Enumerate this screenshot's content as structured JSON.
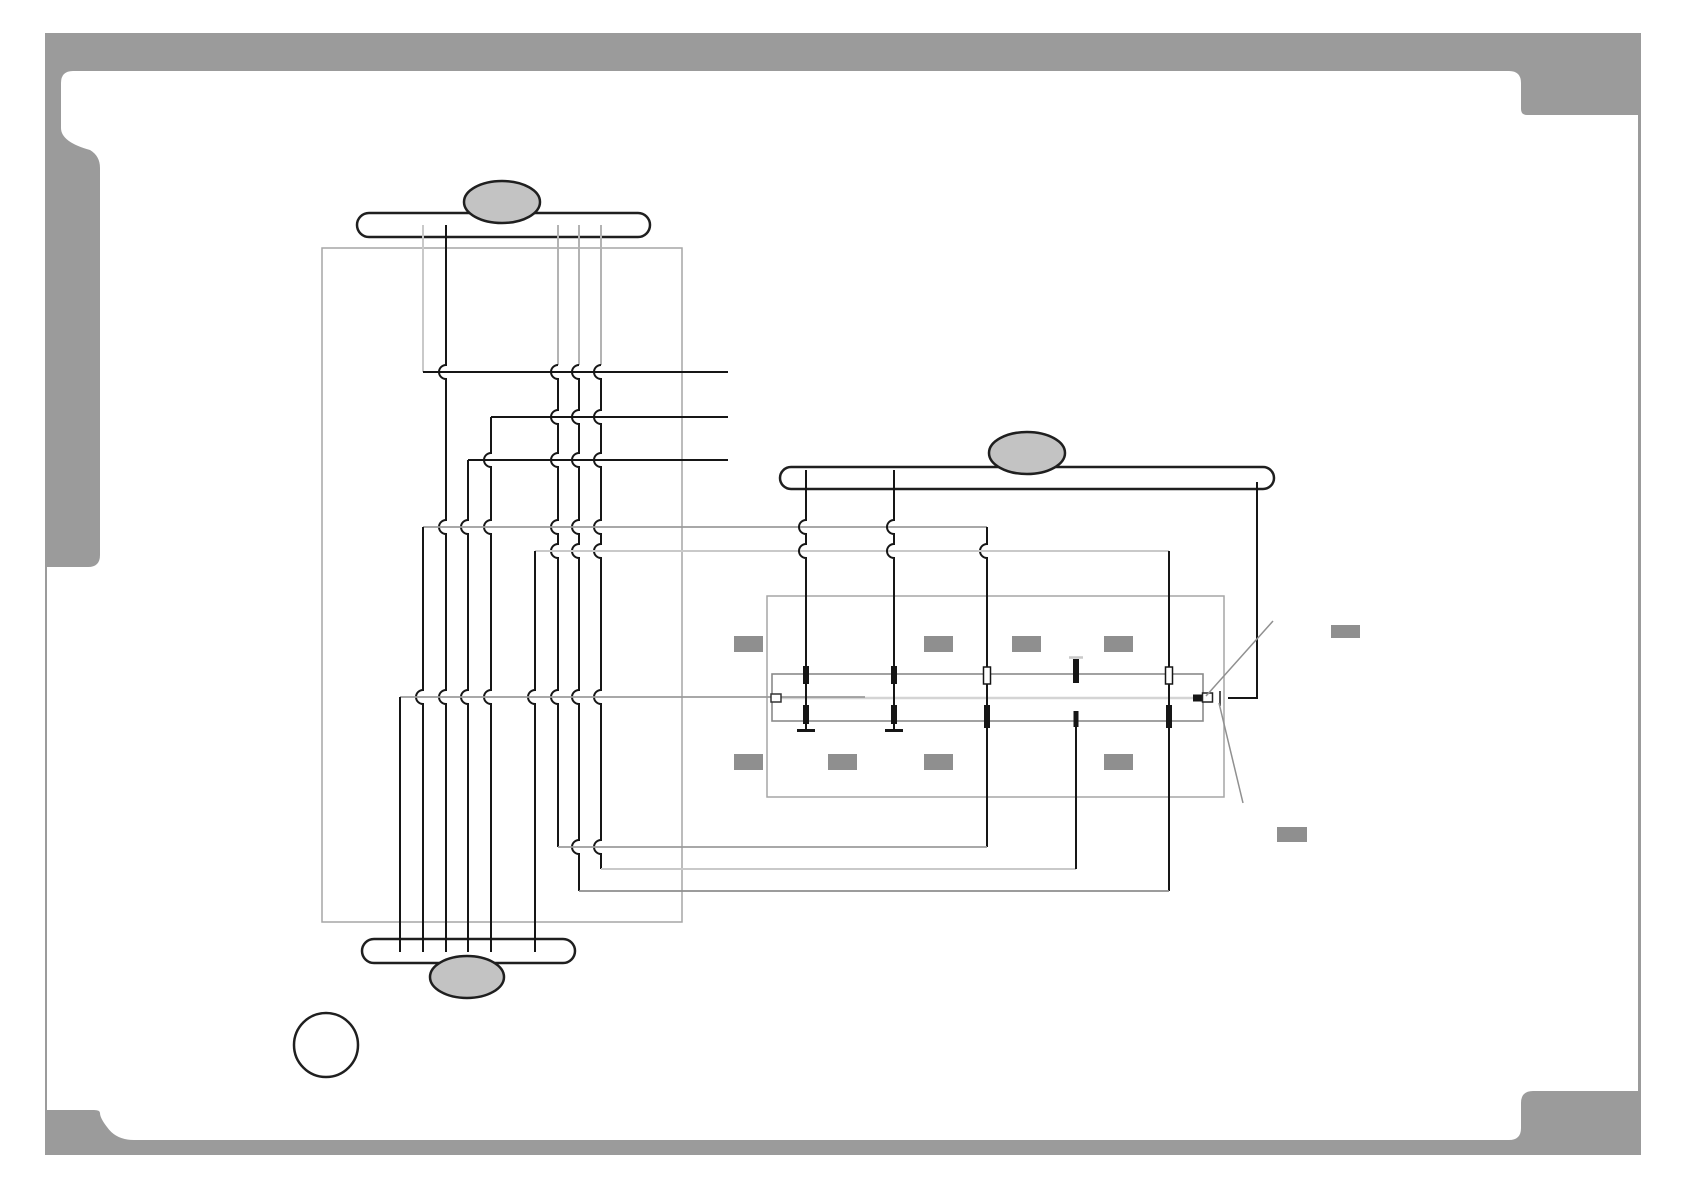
{
  "page": {
    "title": "wiring-connection-diagram",
    "width": 1684,
    "height": 1190,
    "background": "#ffffff"
  },
  "palette": {
    "frame_gray": "#9b9b9b",
    "outline_black": "#1f1f1f",
    "wire_black": "#161616",
    "wire_gray": "#9b9b9b",
    "wire_light_gray": "#c9c9c9",
    "wire_mid_gray": "#8e8e8e",
    "box_outline_gray": "#a6a6a6",
    "strip_outline_gray": "#8a8a8a",
    "oval_fill_gray": "#c3c3c3",
    "tab_fill_gray": "#8f8f8f",
    "strip_midline_gray": "#d4d4d4",
    "leader_gray": "#909090"
  },
  "diagram": {
    "shapes": [
      {
        "name": "page-frame",
        "type": "path",
        "attrs": {
          "d": "M45,33 H1641 V1155 H45 Z M73,71 H1509 Q1521,71 1521,83 V109 Q1521,115 1527,115 H1638 V1091 H1533 Q1521,1091 1521,1103 V1128 Q1521,1140 1509,1140 H134 Q116,1140 107,1127 Q100,1118 100,1113 Q100,1110 94,1110 H47 V567 H88 Q100,567 100,555 V168 Q100,156 90,150 Q61,142 61,128 V83 Q61,71 73,71 Z",
          "fill": "#9b9b9b",
          "fill-rule": "evenodd",
          "stroke": "none"
        }
      },
      {
        "name": "board-outline-left",
        "type": "rect",
        "attrs": {
          "x": 322,
          "y": 248,
          "width": 360,
          "height": 674,
          "fill": "none",
          "stroke": "#a6a6a6",
          "stroke-width": 1.5
        }
      },
      {
        "name": "board-outline-right",
        "type": "rect",
        "attrs": {
          "x": 767,
          "y": 596,
          "width": 457,
          "height": 201,
          "fill": "none",
          "stroke": "#a6a6a6",
          "stroke-width": 1.5
        }
      },
      {
        "name": "connector-strip",
        "type": "rect",
        "attrs": {
          "x": 772,
          "y": 674,
          "width": 431,
          "height": 47,
          "fill": "none",
          "stroke": "#8a8a8a",
          "stroke-width": 1.6
        }
      },
      {
        "name": "connector-strip-midline",
        "type": "path",
        "attrs": {
          "d": "M772,698 H1203",
          "fill": "none",
          "stroke": "#d4d4d4",
          "stroke-width": 2.5
        }
      },
      {
        "name": "bus-bar-top",
        "type": "rect",
        "attrs": {
          "x": 357,
          "y": 213,
          "width": 293,
          "height": 24,
          "rx": 12,
          "fill": "#ffffff",
          "stroke": "#1f1f1f",
          "stroke-width": 2.5
        }
      },
      {
        "name": "bus-bar-middle",
        "type": "rect",
        "attrs": {
          "x": 780,
          "y": 467,
          "width": 494,
          "height": 22,
          "rx": 11,
          "fill": "#ffffff",
          "stroke": "#1f1f1f",
          "stroke-width": 2.5
        }
      },
      {
        "name": "bus-bar-bottom",
        "type": "rect",
        "attrs": {
          "x": 362,
          "y": 939,
          "width": 213,
          "height": 24,
          "rx": 12,
          "fill": "#ffffff",
          "stroke": "#1f1f1f",
          "stroke-width": 2.5
        }
      },
      {
        "name": "cable-oval-top",
        "type": "ellipse",
        "attrs": {
          "cx": 502,
          "cy": 202,
          "rx": 38,
          "ry": 21,
          "fill": "#c3c3c3",
          "stroke": "#1f1f1f",
          "stroke-width": 2.5
        }
      },
      {
        "name": "cable-oval-middle",
        "type": "ellipse",
        "attrs": {
          "cx": 1027,
          "cy": 453,
          "rx": 38,
          "ry": 21,
          "fill": "#c3c3c3",
          "stroke": "#1f1f1f",
          "stroke-width": 2.5
        }
      },
      {
        "name": "cable-oval-bottom",
        "type": "ellipse",
        "attrs": {
          "cx": 467,
          "cy": 977,
          "rx": 37,
          "ry": 21,
          "fill": "#c3c3c3",
          "stroke": "#1f1f1f",
          "stroke-width": 2.5
        }
      },
      {
        "name": "callout-circle",
        "type": "circle",
        "attrs": {
          "cx": 326,
          "cy": 1045,
          "r": 32,
          "fill": "#ffffff",
          "stroke": "#1f1f1f",
          "stroke-width": 2.5
        }
      },
      {
        "name": "wire-v1-upper",
        "type": "path",
        "attrs": {
          "d": "M423,225 V372",
          "fill": "none",
          "stroke": "#c9c9c9",
          "stroke-width": 2
        }
      },
      {
        "name": "wire-row-372",
        "type": "path",
        "attrs": {
          "d": "M423,372 H728",
          "fill": "none",
          "stroke": "#161616",
          "stroke-width": 2
        }
      },
      {
        "name": "wire-v2",
        "type": "path",
        "attrs": {
          "d": "M446,225 V365 A7,7 0 0 0 446,379 V520 A7,7 0 0 0 446,534 V690 A7,7 0 0 0 446,704 V952",
          "fill": "none",
          "stroke": "#161616",
          "stroke-width": 2
        }
      },
      {
        "name": "wire-v6-upper",
        "type": "path",
        "attrs": {
          "d": "M558,225 V365",
          "fill": "none",
          "stroke": "#b3b3b3",
          "stroke-width": 2
        }
      },
      {
        "name": "wire-v6",
        "type": "path",
        "attrs": {
          "d": "M558,365 A7,7 0 0 0 558,379 V410 A7,7 0 0 0 558,424 V453 A7,7 0 0 0 558,467 V520 A7,7 0 0 0 558,534 V544 A7,7 0 0 0 558,558 V690 A7,7 0 0 0 558,704 V847",
          "fill": "none",
          "stroke": "#161616",
          "stroke-width": 2
        }
      },
      {
        "name": "wire-v7-upper",
        "type": "path",
        "attrs": {
          "d": "M579,225 V365",
          "fill": "none",
          "stroke": "#b3b3b3",
          "stroke-width": 2
        }
      },
      {
        "name": "wire-v7",
        "type": "path",
        "attrs": {
          "d": "M579,365 A7,7 0 0 0 579,379 V410 A7,7 0 0 0 579,424 V453 A7,7 0 0 0 579,467 V520 A7,7 0 0 0 579,534 V544 A7,7 0 0 0 579,558 V690 A7,7 0 0 0 579,704 V840 A7,7 0 0 0 579,854 V891",
          "fill": "none",
          "stroke": "#161616",
          "stroke-width": 2
        }
      },
      {
        "name": "wire-v8-upper",
        "type": "path",
        "attrs": {
          "d": "M601,225 V365",
          "fill": "none",
          "stroke": "#b3b3b3",
          "stroke-width": 2
        }
      },
      {
        "name": "wire-v8",
        "type": "path",
        "attrs": {
          "d": "M601,365 A7,7 0 0 0 601,379 V410 A7,7 0 0 0 601,424 V453 A7,7 0 0 0 601,467 V520 A7,7 0 0 0 601,534 V544 A7,7 0 0 0 601,558 V690 A7,7 0 0 0 601,704 V840 A7,7 0 0 0 601,854 V869",
          "fill": "none",
          "stroke": "#161616",
          "stroke-width": 2
        }
      },
      {
        "name": "wire-row-417",
        "type": "path",
        "attrs": {
          "d": "M491,417 H728",
          "fill": "none",
          "stroke": "#161616",
          "stroke-width": 2
        }
      },
      {
        "name": "wire-v4",
        "type": "path",
        "attrs": {
          "d": "M491,417 V453 A7,7 0 0 0 491,467 V520 A7,7 0 0 0 491,534 V690 A7,7 0 0 0 491,704 V952",
          "fill": "none",
          "stroke": "#161616",
          "stroke-width": 2
        }
      },
      {
        "name": "wire-row-460",
        "type": "path",
        "attrs": {
          "d": "M468,460 H728",
          "fill": "none",
          "stroke": "#161616",
          "stroke-width": 2
        }
      },
      {
        "name": "wire-v3",
        "type": "path",
        "attrs": {
          "d": "M468,460 V520 A7,7 0 0 0 468,534 V690 A7,7 0 0 0 468,704 V952",
          "fill": "none",
          "stroke": "#161616",
          "stroke-width": 2
        }
      },
      {
        "name": "wire-row-527",
        "type": "path",
        "attrs": {
          "d": "M423,527 H987",
          "fill": "none",
          "stroke": "#9b9b9b",
          "stroke-width": 1.8
        }
      },
      {
        "name": "wire-v1-lower",
        "type": "path",
        "attrs": {
          "d": "M423,527 V690 A7,7 0 0 0 423,704 V952",
          "fill": "none",
          "stroke": "#161616",
          "stroke-width": 2
        }
      },
      {
        "name": "wire-v987",
        "type": "path",
        "attrs": {
          "d": "M987,527 V544 A7,7 0 0 0 987,558 V847",
          "fill": "none",
          "stroke": "#161616",
          "stroke-width": 2
        }
      },
      {
        "name": "wire-row-551",
        "type": "path",
        "attrs": {
          "d": "M535,551 H1169",
          "fill": "none",
          "stroke": "#c9c9c9",
          "stroke-width": 2
        }
      },
      {
        "name": "wire-v5",
        "type": "path",
        "attrs": {
          "d": "M535,551 V690 A7,7 0 0 0 535,704 V952",
          "fill": "none",
          "stroke": "#161616",
          "stroke-width": 2
        }
      },
      {
        "name": "wire-v1169",
        "type": "path",
        "attrs": {
          "d": "M1169,551 V891",
          "fill": "none",
          "stroke": "#161616",
          "stroke-width": 2
        }
      },
      {
        "name": "wire-row-697",
        "type": "path",
        "attrs": {
          "d": "M400,697 H865",
          "fill": "none",
          "stroke": "#9b9b9b",
          "stroke-width": 1.8
        }
      },
      {
        "name": "wire-v400",
        "type": "path",
        "attrs": {
          "d": "M400,697 V952",
          "fill": "none",
          "stroke": "#161616",
          "stroke-width": 2
        }
      },
      {
        "name": "wire-row-847",
        "type": "path",
        "attrs": {
          "d": "M558,847 H987",
          "fill": "none",
          "stroke": "#9b9b9b",
          "stroke-width": 1.8
        }
      },
      {
        "name": "wire-row-869",
        "type": "path",
        "attrs": {
          "d": "M601,869 H1076",
          "fill": "none",
          "stroke": "#c9c9c9",
          "stroke-width": 2
        }
      },
      {
        "name": "wire-row-891",
        "type": "path",
        "attrs": {
          "d": "M579,891 H1169",
          "fill": "none",
          "stroke": "#8e8e8e",
          "stroke-width": 1.8
        }
      },
      {
        "name": "wire-v806",
        "type": "path",
        "attrs": {
          "d": "M806,470 V520 A7,7 0 0 0 806,534 V544 A7,7 0 0 0 806,558 V729",
          "fill": "none",
          "stroke": "#161616",
          "stroke-width": 2
        }
      },
      {
        "name": "wire-v806-foot",
        "type": "path",
        "attrs": {
          "d": "M797,730.5 H815",
          "fill": "none",
          "stroke": "#161616",
          "stroke-width": 3
        }
      },
      {
        "name": "wire-v894",
        "type": "path",
        "attrs": {
          "d": "M894,470 V520 A7,7 0 0 0 894,534 V544 A7,7 0 0 0 894,558 V729",
          "fill": "none",
          "stroke": "#161616",
          "stroke-width": 2
        }
      },
      {
        "name": "wire-v894-foot",
        "type": "path",
        "attrs": {
          "d": "M885,730.5 H903",
          "fill": "none",
          "stroke": "#161616",
          "stroke-width": 3
        }
      },
      {
        "name": "wire-v1257",
        "type": "path",
        "attrs": {
          "d": "M1257,482 V698 H1228",
          "fill": "none",
          "stroke": "#161616",
          "stroke-width": 2
        }
      },
      {
        "name": "strip-end-tick",
        "type": "path",
        "attrs": {
          "d": "M1220,691 V706",
          "fill": "none",
          "stroke": "#161616",
          "stroke-width": 1.5
        }
      },
      {
        "name": "wire-v1076-cap",
        "type": "path",
        "attrs": {
          "d": "M1069,657.5 H1083",
          "fill": "none",
          "stroke": "#c9c9c9",
          "stroke-width": 2.5
        }
      },
      {
        "name": "wire-v1076-pin",
        "type": "rect",
        "attrs": {
          "x": 1073,
          "y": 659,
          "width": 6,
          "height": 24,
          "fill": "#161616",
          "stroke": "none"
        }
      },
      {
        "name": "wire-v1076-lower",
        "type": "path",
        "attrs": {
          "d": "M1076,711 V869",
          "fill": "none",
          "stroke": "#161616",
          "stroke-width": 2
        }
      },
      {
        "name": "wire-v1076-thick",
        "type": "rect",
        "attrs": {
          "x": 1073.5,
          "y": 711,
          "width": 5,
          "height": 16,
          "fill": "#161616",
          "stroke": "none"
        }
      },
      {
        "name": "strip-pin-806-top",
        "type": "rect",
        "attrs": {
          "x": 803,
          "y": 666,
          "width": 6,
          "height": 18,
          "fill": "#161616",
          "stroke": "none"
        }
      },
      {
        "name": "strip-pin-894-top",
        "type": "rect",
        "attrs": {
          "x": 891,
          "y": 666,
          "width": 6,
          "height": 18,
          "fill": "#161616",
          "stroke": "none"
        }
      },
      {
        "name": "strip-pin-806-bottom",
        "type": "rect",
        "attrs": {
          "x": 803,
          "y": 705,
          "width": 6,
          "height": 19,
          "fill": "#161616",
          "stroke": "none"
        }
      },
      {
        "name": "strip-pin-894-bottom",
        "type": "rect",
        "attrs": {
          "x": 891,
          "y": 705,
          "width": 6,
          "height": 19,
          "fill": "#161616",
          "stroke": "none"
        }
      },
      {
        "name": "strip-pin-987-top-hollow",
        "type": "rect",
        "attrs": {
          "x": 983.5,
          "y": 667,
          "width": 7,
          "height": 17,
          "fill": "#ffffff",
          "stroke": "#161616",
          "stroke-width": 1.5
        }
      },
      {
        "name": "strip-pin-987-bottom",
        "type": "rect",
        "attrs": {
          "x": 984,
          "y": 705,
          "width": 6,
          "height": 23,
          "fill": "#161616",
          "stroke": "none"
        }
      },
      {
        "name": "strip-pin-1169-top-hollow",
        "type": "rect",
        "attrs": {
          "x": 1165.5,
          "y": 667,
          "width": 7,
          "height": 17,
          "fill": "#ffffff",
          "stroke": "#161616",
          "stroke-width": 1.5
        }
      },
      {
        "name": "strip-pin-1169-bottom",
        "type": "rect",
        "attrs": {
          "x": 1166,
          "y": 705,
          "width": 6,
          "height": 23,
          "fill": "#161616",
          "stroke": "none"
        }
      },
      {
        "name": "strip-left-connector",
        "type": "rect",
        "attrs": {
          "x": 771,
          "y": 694,
          "width": 10,
          "height": 8,
          "fill": "#ffffff",
          "stroke": "#333333",
          "stroke-width": 1.5
        }
      },
      {
        "name": "strip-right-connector-solid",
        "type": "rect",
        "attrs": {
          "x": 1193,
          "y": 694.5,
          "width": 12,
          "height": 7,
          "fill": "#161616",
          "stroke": "none"
        }
      },
      {
        "name": "strip-right-connector-hollow",
        "type": "rect",
        "attrs": {
          "x": 1202.5,
          "y": 693,
          "width": 10,
          "height": 9,
          "fill": "#ffffff",
          "stroke": "#222222",
          "stroke-width": 1.5
        }
      },
      {
        "name": "label-tab-upper-1",
        "type": "rect",
        "attrs": {
          "x": 734,
          "y": 636,
          "width": 29,
          "height": 16,
          "fill": "#8f8f8f",
          "stroke": "none"
        }
      },
      {
        "name": "label-tab-upper-2",
        "type": "rect",
        "attrs": {
          "x": 924,
          "y": 636,
          "width": 29,
          "height": 16,
          "fill": "#8f8f8f",
          "stroke": "none"
        }
      },
      {
        "name": "label-tab-upper-3",
        "type": "rect",
        "attrs": {
          "x": 1012,
          "y": 636,
          "width": 29,
          "height": 16,
          "fill": "#8f8f8f",
          "stroke": "none"
        }
      },
      {
        "name": "label-tab-upper-4",
        "type": "rect",
        "attrs": {
          "x": 1104,
          "y": 636,
          "width": 29,
          "height": 16,
          "fill": "#8f8f8f",
          "stroke": "none"
        }
      },
      {
        "name": "label-tab-lower-1",
        "type": "rect",
        "attrs": {
          "x": 734,
          "y": 754,
          "width": 29,
          "height": 16,
          "fill": "#8f8f8f",
          "stroke": "none"
        }
      },
      {
        "name": "label-tab-lower-2",
        "type": "rect",
        "attrs": {
          "x": 828,
          "y": 754,
          "width": 29,
          "height": 16,
          "fill": "#8f8f8f",
          "stroke": "none"
        }
      },
      {
        "name": "label-tab-lower-3",
        "type": "rect",
        "attrs": {
          "x": 924,
          "y": 754,
          "width": 29,
          "height": 16,
          "fill": "#8f8f8f",
          "stroke": "none"
        }
      },
      {
        "name": "label-tab-lower-4",
        "type": "rect",
        "attrs": {
          "x": 1104,
          "y": 754,
          "width": 29,
          "height": 16,
          "fill": "#8f8f8f",
          "stroke": "none"
        }
      },
      {
        "name": "callout-tab-right-upper",
        "type": "rect",
        "attrs": {
          "x": 1331,
          "y": 625,
          "width": 29,
          "height": 13,
          "fill": "#8f8f8f",
          "stroke": "none"
        }
      },
      {
        "name": "callout-tab-right-lower",
        "type": "rect",
        "attrs": {
          "x": 1277,
          "y": 827,
          "width": 30,
          "height": 15,
          "fill": "#8f8f8f",
          "stroke": "none"
        }
      },
      {
        "name": "leader-line-upper",
        "type": "path",
        "attrs": {
          "d": "M1273,621 L1206,696",
          "fill": "none",
          "stroke": "#909090",
          "stroke-width": 1.5
        }
      },
      {
        "name": "leader-line-lower",
        "type": "path",
        "attrs": {
          "d": "M1219,703 L1243,803",
          "fill": "none",
          "stroke": "#909090",
          "stroke-width": 1.5
        }
      }
    ]
  }
}
